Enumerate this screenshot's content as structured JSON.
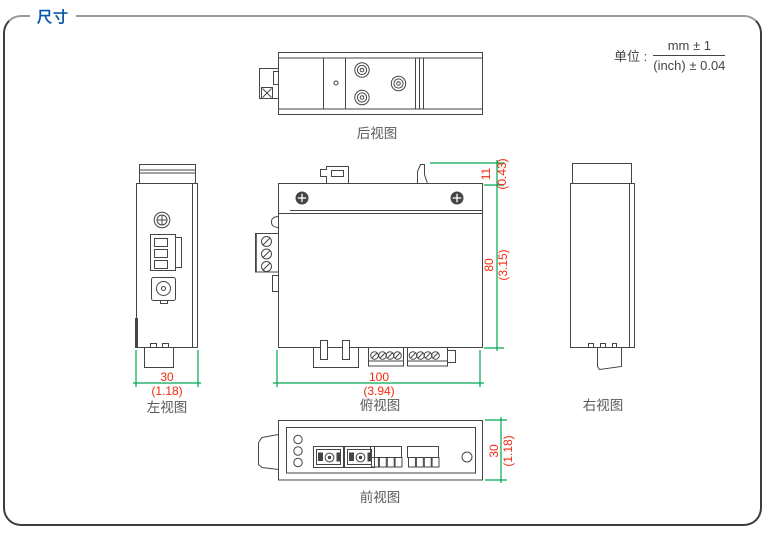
{
  "title": "尺寸",
  "unit": {
    "label": "单位 :",
    "numerator": "mm ± 1",
    "denominator": "(inch) ± 0.04"
  },
  "views": {
    "rear": {
      "label": "后视图"
    },
    "left": {
      "label": "左视图"
    },
    "top": {
      "label": "俯视图"
    },
    "right": {
      "label": "右视图"
    },
    "front": {
      "label": "前视图"
    }
  },
  "dimensions": {
    "left_width_mm": "30",
    "left_width_inch": "(1.18)",
    "top_width_mm": "100",
    "top_width_inch": "(3.94)",
    "top_height_mm": "80",
    "top_height_inch": "(3.15)",
    "clip_height_mm": "11",
    "clip_height_inch": "(0.43)",
    "front_height_mm": "30",
    "front_height_inch": "(1.18)"
  },
  "colors": {
    "title_blue": "#0a5aab",
    "dimension_text_red": "#f42a0f",
    "dimension_line_green": "#00a651",
    "outline_gray": "#454545",
    "label_gray": "#595959"
  }
}
